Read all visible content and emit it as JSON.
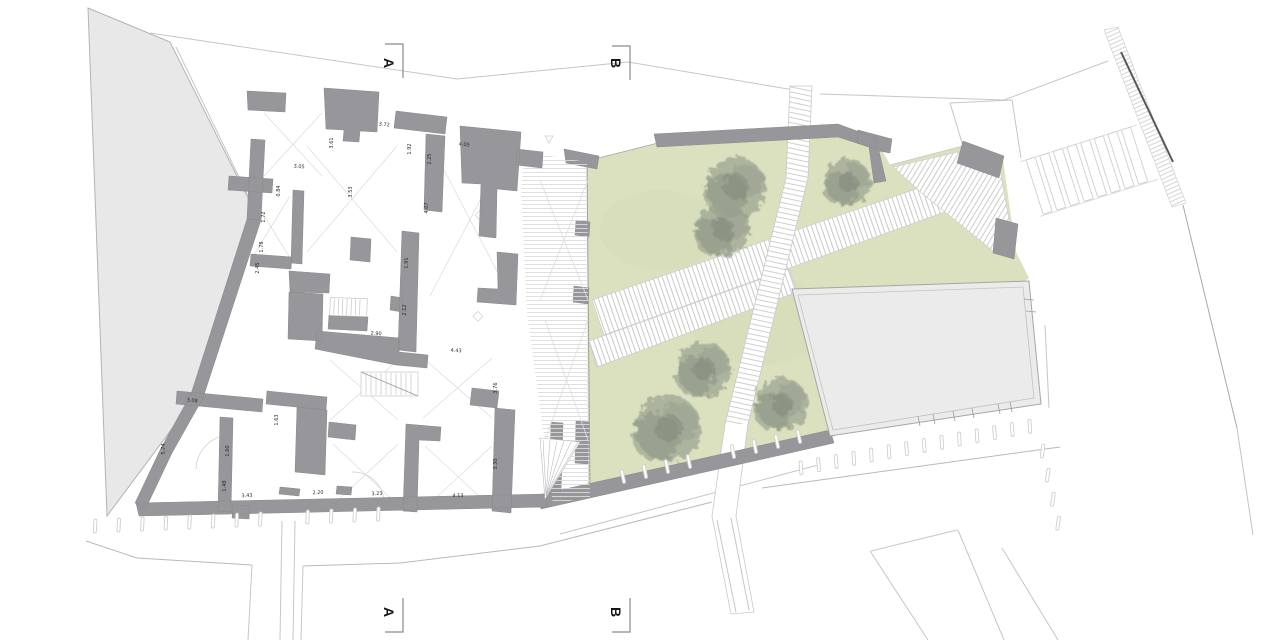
{
  "title": {
    "drawing_letters": "A B"
  },
  "section_markers": {
    "a": "A",
    "b": "B"
  },
  "colors": {
    "background": "#ffffff",
    "wall_gray": "#97979b",
    "site_area_gray": "#e8e8e8",
    "plaza_gray": "#ebebeb",
    "garden_green": "#dbe0bf",
    "tree_gray_green": "#99a18f",
    "hatch_line": "#d9d9d9",
    "context_line": "#c6c6c6",
    "dark_edge": "#58585a",
    "text_color": "#2b2b2b"
  },
  "dimension_labels": [
    {
      "label": "3.05",
      "x": 299,
      "y": 168,
      "rot": 4
    },
    {
      "label": "3.61",
      "x": 333,
      "y": 143,
      "rot": -90
    },
    {
      "label": "3.72",
      "x": 384,
      "y": 126,
      "rot": 7
    },
    {
      "label": "1.92",
      "x": 411,
      "y": 149,
      "rot": -90
    },
    {
      "label": "2.25",
      "x": 431,
      "y": 159,
      "rot": -90
    },
    {
      "label": "4.05",
      "x": 464,
      "y": 146,
      "rot": 7
    },
    {
      "label": "3.53",
      "x": 352,
      "y": 192,
      "rot": -90
    },
    {
      "label": "0.84",
      "x": 280,
      "y": 191,
      "rot": -90
    },
    {
      "label": "1.72",
      "x": 265,
      "y": 217,
      "rot": -90
    },
    {
      "label": "1.78",
      "x": 263,
      "y": 247,
      "rot": -90
    },
    {
      "label": "2.45",
      "x": 259,
      "y": 268,
      "rot": -90
    },
    {
      "label": "4.07",
      "x": 428,
      "y": 208,
      "rot": -90
    },
    {
      "label": "1.91",
      "x": 408,
      "y": 263,
      "rot": -90
    },
    {
      "label": "2.12",
      "x": 406,
      "y": 310,
      "rot": -90
    },
    {
      "label": "2.90",
      "x": 376,
      "y": 335,
      "rot": 4
    },
    {
      "label": "4.43",
      "x": 456,
      "y": 352,
      "rot": 4
    },
    {
      "label": "3.76",
      "x": 497,
      "y": 388,
      "rot": -90
    },
    {
      "label": "3.30",
      "x": 497,
      "y": 464,
      "rot": -90
    },
    {
      "label": "3.23",
      "x": 377,
      "y": 495,
      "rot": -2
    },
    {
      "label": "4.13",
      "x": 458,
      "y": 497,
      "rot": -2
    },
    {
      "label": "2.20",
      "x": 318,
      "y": 494,
      "rot": -2
    },
    {
      "label": "3.43",
      "x": 247,
      "y": 497,
      "rot": -2
    },
    {
      "label": "3.08",
      "x": 192,
      "y": 402,
      "rot": 7
    },
    {
      "label": "5.74",
      "x": 165,
      "y": 449,
      "rot": -90
    },
    {
      "label": "1.60",
      "x": 229,
      "y": 451,
      "rot": -90
    },
    {
      "label": "1.48",
      "x": 226,
      "y": 486,
      "rot": -90
    },
    {
      "label": "1.63",
      "x": 278,
      "y": 420,
      "rot": -90
    }
  ],
  "trees": [
    {
      "cx": 736,
      "cy": 187,
      "r": 30
    },
    {
      "cx": 723,
      "cy": 229,
      "r": 27
    },
    {
      "cx": 848,
      "cy": 182,
      "r": 23
    },
    {
      "cx": 704,
      "cy": 369,
      "r": 27
    },
    {
      "cx": 668,
      "cy": 428,
      "r": 33
    },
    {
      "cx": 782,
      "cy": 404,
      "r": 26
    }
  ]
}
